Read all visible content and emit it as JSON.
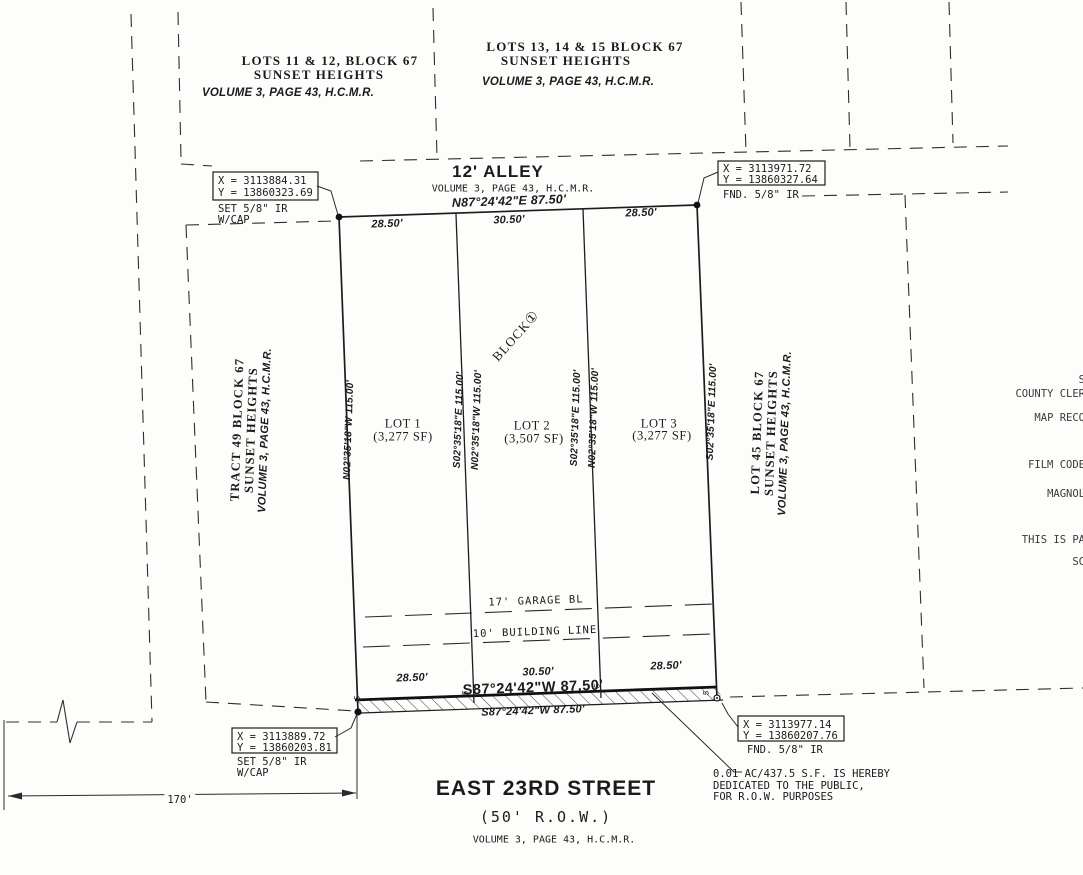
{
  "neighbors": {
    "top_left": [
      "LOTS 11 & 12, BLOCK 67",
      "SUNSET HEIGHTS",
      "VOLUME 3, PAGE 43, H.C.M.R."
    ],
    "top_right": [
      "LOTS 13, 14 & 15 BLOCK 67",
      "SUNSET HEIGHTS",
      "VOLUME 3, PAGE 43, H.C.M.R."
    ],
    "west": [
      "TRACT 49 BLOCK 67",
      "SUNSET HEIGHTS",
      "VOLUME 3, PAGE 43, H.C.M.R."
    ],
    "east": [
      "LOT 45 BLOCK 67",
      "SUNSET HEIGHTS",
      "VOLUME 3, PAGE 43, H.C.M.R."
    ]
  },
  "alley": {
    "title": "12' ALLEY",
    "volume": "VOLUME 3, PAGE 43, H.C.M.R.",
    "bearing": "N87°24'42\"E  87.50'",
    "segments": [
      "28.50'",
      "30.50'",
      "28.50'"
    ]
  },
  "block": {
    "name": "BLOCK",
    "number": "①"
  },
  "lots": [
    {
      "name": "LOT 1",
      "area": "(3,277 SF)"
    },
    {
      "name": "LOT 2",
      "area": "(3,507 SF)"
    },
    {
      "name": "LOT 3",
      "area": "(3,277 SF)"
    }
  ],
  "side_bearings": {
    "west": "N02°35'18\"W  115.00'",
    "div1_w": "S02°35'18\"E  115.00'",
    "div1_e": "N02°35'18\"W  115.00'",
    "div2_w": "S02°35'18\"E  115.00'",
    "div2_e": "N02°35'18\"W  115.00'",
    "east": "S02°35'18\"E  115.00'"
  },
  "monuments": {
    "top_left": {
      "x": "X = 3113884.31",
      "y": "Y = 13860323.69",
      "desc": "SET 5/8\" IR",
      "desc2": "W/CAP"
    },
    "top_right": {
      "x": "X = 3113971.72",
      "y": "Y = 13860327.64",
      "desc": "FND. 5/8\" IR"
    },
    "bottom_left": {
      "x": "X = 3113889.72",
      "y": "Y = 13860203.81",
      "desc": "SET 5/8\" IR",
      "desc2": "W/CAP"
    },
    "bottom_right": {
      "x": "X = 3113977.14",
      "y": "Y = 13860207.76",
      "desc": "FND. 5/8\" IR"
    }
  },
  "building_lines": {
    "garage": "17' GARAGE BL",
    "building": "10' BUILDING LINE"
  },
  "south_line": {
    "bearing_bold": "S87°24'42\"W 87.50'",
    "bearing": "S87°24'42\"W  87.50'",
    "segments": [
      "28.50'",
      "30.50'",
      "28.50'"
    ],
    "ticks": [
      "5",
      "5",
      "5",
      "5"
    ]
  },
  "street": {
    "name": "EAST 23RD STREET",
    "row": "(50' R.O.W.)",
    "volume": "VOLUME 3, PAGE 43, H.C.M.R."
  },
  "dedication": [
    "0.01 AC/437.5 S.F. IS HEREBY",
    "DEDICATED TO THE PUBLIC,",
    "FOR R.O.W. PURPOSES"
  ],
  "dimension": {
    "width": "170'"
  },
  "margin_text": [
    "S",
    "COUNTY CLER",
    "MAP RECO",
    "FILM CODE",
    "MAGNOL",
    "THIS IS PA",
    "SC"
  ]
}
